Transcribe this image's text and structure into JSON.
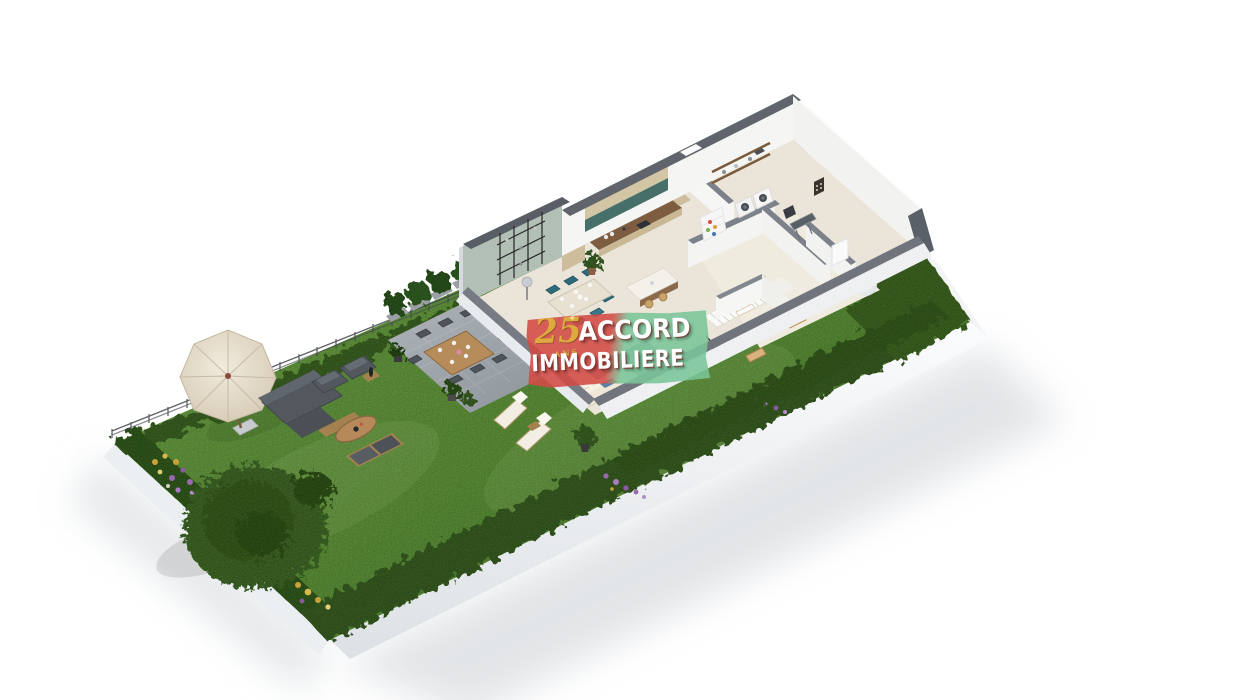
{
  "page": {
    "background": "#ffffff",
    "description": "Isometric 3D floor-plan rendering of a ground floor with furnished interior (kitchen, dining area, living room, laundry, staircase, bathroom) and a landscaped garden (lawn, hedges, parasol, outdoor lounge set, sun loungers, patio dining set, conifer tree, flower beds) on a white background."
  },
  "watermark": {
    "line1": "ACCORD",
    "line2": "IMMOBILIERE",
    "badge_number": "25",
    "badge_label": "ANS",
    "colors": {
      "red": "#d34a44",
      "green": "#7ac599",
      "text": "#ffffff",
      "gold": "#dcaa3e"
    }
  },
  "palette": {
    "lawn": "#5c8f3a",
    "hedge": "#3a5f25",
    "patio_stone": "#9aa1a8",
    "wall_top": "#63686f",
    "wall_face": "#f4f4f2",
    "floor": "#eae5d8",
    "wood": "#b18a58",
    "counter_wood": "#7d5c40",
    "cabinet_tan": "#c9b895",
    "sage_wall": "#b2bfb4",
    "teal_chair": "#2e6b7a",
    "outdoor_gray": "#53585f",
    "parasol_canvas": "#e9e1d1"
  }
}
